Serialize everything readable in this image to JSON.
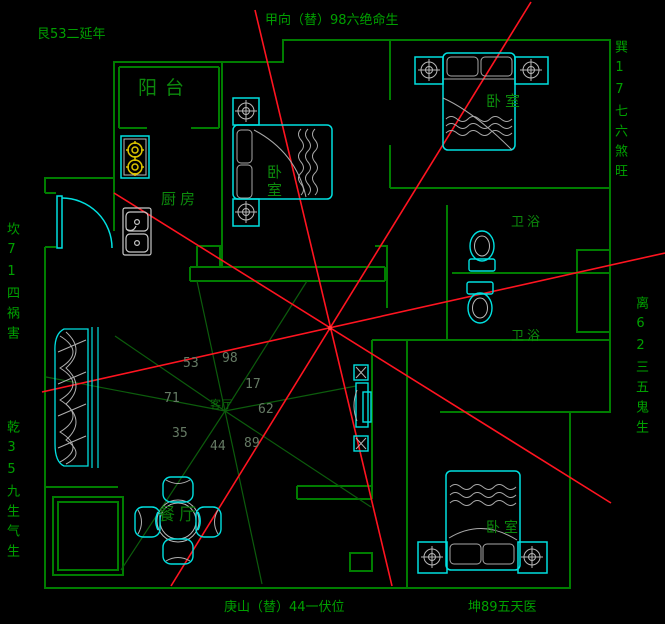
{
  "drawing": {
    "type": "fengshui-floorplan",
    "boundary_labels": {
      "top_left": "艮53二延年",
      "top_center": "甲向（替）98六绝命生",
      "top_right_vertical": "巽17七六煞旺",
      "left_upper_vertical": "坎71四祸害",
      "left_lower_vertical": "乾35九生气生",
      "right_vertical": "离62三五鬼生",
      "bottom_center": "庚山（替）44一伏位",
      "bottom_right": "坤89五天医"
    },
    "rooms": {
      "balcony": "阳台",
      "kitchen": "厨房",
      "bedroom_middle": "卧室",
      "bedroom_top_right": "卧室",
      "bedroom_bottom_right": "卧室",
      "bath_upper": "卫浴",
      "bath_lower": "卫浴",
      "living_room": "客厅",
      "dining_room": "餐厅"
    },
    "sector_numbers": {
      "n53": "53",
      "n98": "98",
      "n17": "17",
      "n71": "71",
      "n62": "62",
      "n35": "35",
      "n44": "44",
      "n89": "89"
    },
    "colors": {
      "background": "#000000",
      "wall_green": "#007d00",
      "label_green": "#00a000",
      "furniture_cyan": "#00e0e0",
      "detail_gray": "#b8b8b8",
      "burner_yellow": "#ddc500",
      "sight_line_red": "#ff1420",
      "ray_dark_green": "#0c5c0c",
      "number_gray_green": "#657a64"
    }
  }
}
